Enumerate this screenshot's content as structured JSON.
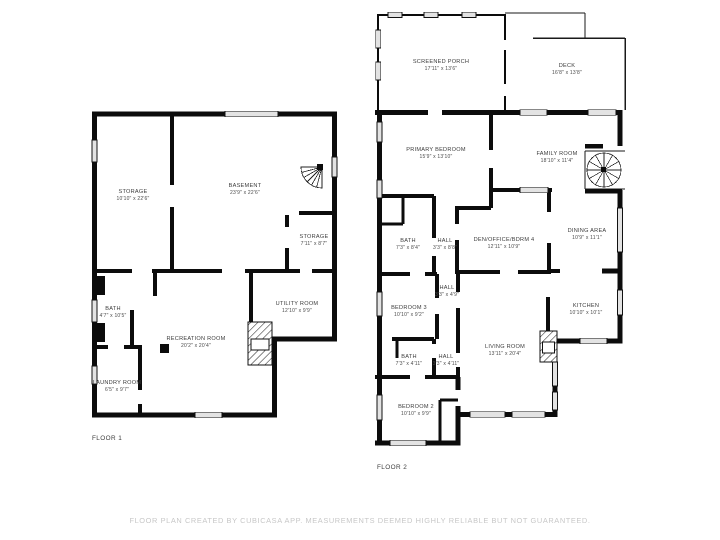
{
  "document": {
    "type": "floor-plan",
    "footer_text": "FLOOR PLAN CREATED BY CUBICASA APP. MEASUREMENTS DEEMED HIGHLY RELIABLE BUT NOT GUARANTEED."
  },
  "colors": {
    "background": "#ffffff",
    "wall": "#0c0c0c",
    "window_fill": "#e3e3e3",
    "label_text": "#3c3c3c",
    "footer_text": "#c7c7c7"
  },
  "floor1": {
    "caption": "FLOOR 1",
    "rooms": [
      {
        "id": "storage-upper",
        "name": "STORAGE",
        "dims": "10'10\" x 22'6\""
      },
      {
        "id": "basement",
        "name": "BASEMENT",
        "dims": "23'9\" x 22'6\""
      },
      {
        "id": "storage-lower",
        "name": "STORAGE",
        "dims": "7'11\" x 8'7\""
      },
      {
        "id": "bath",
        "name": "BATH",
        "dims": "4'7\" x 10'5\""
      },
      {
        "id": "utility-room",
        "name": "UTILITY ROOM",
        "dims": "12'10\" x 9'9\""
      },
      {
        "id": "recreation-room",
        "name": "RECREATION ROOM",
        "dims": "20'2\" x 20'4\""
      },
      {
        "id": "laundry-room",
        "name": "LAUNDRY ROOM",
        "dims": "6'5\" x 9'7\""
      }
    ]
  },
  "floor2": {
    "caption": "FLOOR 2",
    "rooms": [
      {
        "id": "screened-porch",
        "name": "SCREENED PORCH",
        "dims": "17'11\" x 13'6\""
      },
      {
        "id": "deck",
        "name": "DECK",
        "dims": "16'8\" x 13'8\""
      },
      {
        "id": "primary-bedroom",
        "name": "PRIMARY BEDROOM",
        "dims": "15'9\" x 13'10\""
      },
      {
        "id": "family-room",
        "name": "FAMILY ROOM",
        "dims": "18'10\" x 11'4\""
      },
      {
        "id": "bath-upper",
        "name": "BATH",
        "dims": "7'3\" x 8'4\""
      },
      {
        "id": "hall-upper",
        "name": "HALL",
        "dims": "3'3\" x 8'8\""
      },
      {
        "id": "den-office-bdrm4",
        "name": "DEN/OFFICE/BDRM 4",
        "dims": "12'11\" x 10'9\""
      },
      {
        "id": "dining-area",
        "name": "DINING AREA",
        "dims": "10'9\" x 11'1\""
      },
      {
        "id": "hall-middle",
        "name": "HALL",
        "dims": "3'3\" x 4'9\""
      },
      {
        "id": "bedroom-3",
        "name": "BEDROOM 3",
        "dims": "10'10\" x 9'2\""
      },
      {
        "id": "kitchen",
        "name": "KITCHEN",
        "dims": "10'10\" x 10'1\""
      },
      {
        "id": "bath-lower",
        "name": "BATH",
        "dims": "7'3\" x 4'11\""
      },
      {
        "id": "hall-lower",
        "name": "HALL",
        "dims": "3'3\" x 4'11\""
      },
      {
        "id": "living-room",
        "name": "LIVING ROOM",
        "dims": "13'11\" x 20'4\""
      },
      {
        "id": "bedroom-2",
        "name": "BEDROOM 2",
        "dims": "10'10\" x 9'9\""
      }
    ]
  }
}
